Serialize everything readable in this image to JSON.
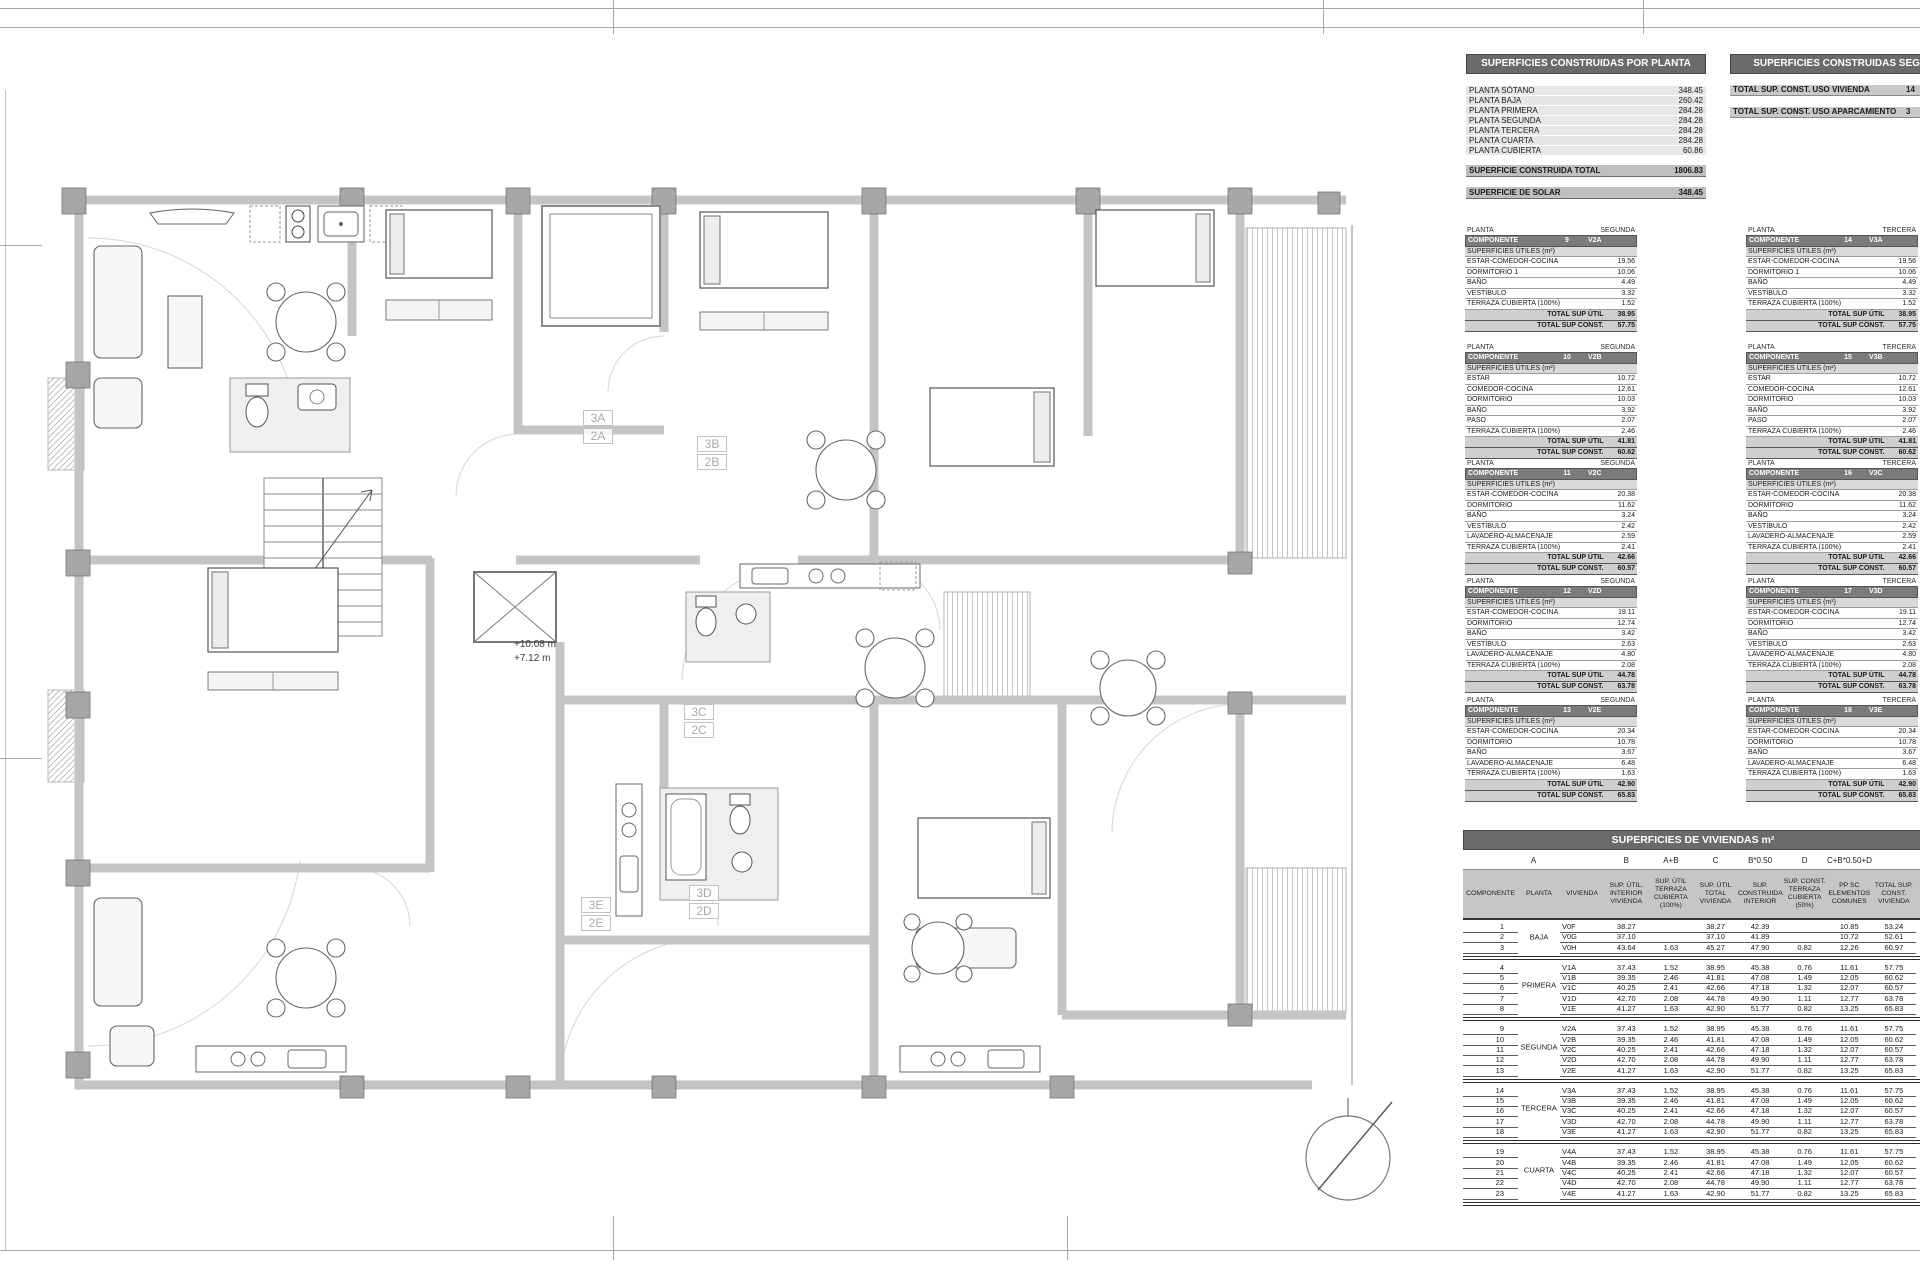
{
  "plan": {
    "elevation": {
      "line1": "+10.08 m",
      "line2": "+7.12 m"
    },
    "unit_labels": [
      {
        "line1": "3A",
        "line2": "2A",
        "style": "left:583px;top:410px"
      },
      {
        "line1": "3B",
        "line2": "2B",
        "style": "left:697px;top:436px"
      },
      {
        "line1": "3C",
        "line2": "2C",
        "style": "left:684px;top:704px"
      },
      {
        "line1": "3D",
        "line2": "2D",
        "style": "left:689px;top:885px"
      },
      {
        "line1": "3E",
        "line2": "2E",
        "style": "left:581px;top:897px"
      }
    ]
  },
  "table_por_planta": {
    "title": "SUPERFICIES CONSTRUIDAS POR PLANTA",
    "rows": [
      [
        "PLANTA SÓTANO",
        "348.45"
      ],
      [
        "PLANTA BAJA",
        "260.42"
      ],
      [
        "PLANTA PRIMERA",
        "284.28"
      ],
      [
        "PLANTA SEGUNDA",
        "284.28"
      ],
      [
        "PLANTA TERCERA",
        "284.28"
      ],
      [
        "PLANTA CUARTA",
        "284.28"
      ],
      [
        "PLANTA CUBIERTA",
        "60.86"
      ]
    ],
    "total_label": "SUPERFICIE CONSTRUIDA TOTAL",
    "total_value": "1806.83",
    "solar_label": "SUPERFICIE DE SOLAR",
    "solar_value": "348.45"
  },
  "table_segun_uso": {
    "title": "SUPERFICIES CONSTRUIDAS SEGÚN USO",
    "rows": [
      [
        "TOTAL SUP. CONST. USO VIVIENDA",
        "14"
      ],
      [
        "TOTAL SUP. CONST. USO APARCAMIENTO",
        "3"
      ]
    ]
  },
  "component_labels": {
    "planta": "PLANTA",
    "componente": "COMPONENTE",
    "section": "SUPERFICIES ÚTILES (m²)",
    "total_util": "TOTAL SUP ÚTIL",
    "total_const": "TOTAL SUP CONST."
  },
  "component_tables": [
    {
      "style": "left:1465px;top:226px",
      "planta": "SEGUNDA",
      "num": "9",
      "code": "V2A",
      "rows": [
        [
          "ESTAR-COMEDOR-COCINA",
          "19.56"
        ],
        [
          "DORMITORIO 1",
          "10.06"
        ],
        [
          "BAÑO",
          "4.49"
        ],
        [
          "VESTÍBULO",
          "3.32"
        ],
        [
          "TERRAZA CUBIERTA (100%)",
          "1.52"
        ]
      ],
      "tu": "38.95",
      "tc": "57.75"
    },
    {
      "style": "left:1465px;top:343px",
      "planta": "SEGUNDA",
      "num": "10",
      "code": "V2B",
      "rows": [
        [
          "ESTAR",
          "10.72"
        ],
        [
          "COMEDOR-COCINA",
          "12.61"
        ],
        [
          "DORMITORIO",
          "10.03"
        ],
        [
          "BAÑO",
          "3.92"
        ],
        [
          "PASO",
          "2.07"
        ],
        [
          "TERRAZA CUBIERTA (100%)",
          "2.46"
        ]
      ],
      "tu": "41.81",
      "tc": "60.62"
    },
    {
      "style": "left:1465px;top:459px",
      "planta": "SEGUNDA",
      "num": "11",
      "code": "V2C",
      "rows": [
        [
          "ESTAR-COMEDOR-COCINA",
          "20.38"
        ],
        [
          "DORMITORIO",
          "11.62"
        ],
        [
          "BAÑO",
          "3.24"
        ],
        [
          "VESTÍBULO",
          "2.42"
        ],
        [
          "LAVADERO-ALMACENAJE",
          "2.59"
        ],
        [
          "TERRAZA CUBIERTA (100%)",
          "2.41"
        ]
      ],
      "tu": "42.66",
      "tc": "60.57"
    },
    {
      "style": "left:1465px;top:577px",
      "planta": "SEGUNDA",
      "num": "12",
      "code": "V2D",
      "rows": [
        [
          "ESTAR-COMEDOR-COCINA",
          "19.11"
        ],
        [
          "DORMITORIO",
          "12.74"
        ],
        [
          "BAÑO",
          "3.42"
        ],
        [
          "VESTÍBULO",
          "2.63"
        ],
        [
          "LAVADERO-ALMACENAJE",
          "4.80"
        ],
        [
          "TERRAZA CUBIERTA (100%)",
          "2.08"
        ]
      ],
      "tu": "44.78",
      "tc": "63.78"
    },
    {
      "style": "left:1465px;top:696px",
      "planta": "SEGUNDA",
      "num": "13",
      "code": "V2E",
      "rows": [
        [
          "ESTAR-COMEDOR-COCINA",
          "20.34"
        ],
        [
          "DORMITORIO",
          "10.78"
        ],
        [
          "BAÑO",
          "3.67"
        ],
        [
          "LAVADERO-ALMACENAJE",
          "6.48"
        ],
        [
          "TERRAZA CUBIERTA (100%)",
          "1.63"
        ]
      ],
      "tu": "42.90",
      "tc": "65.83"
    },
    {
      "style": "left:1746px;top:226px",
      "planta": "TERCERA",
      "num": "14",
      "code": "V3A",
      "rows": [
        [
          "ESTAR-COMEDOR-COCINA",
          "19.56"
        ],
        [
          "DORMITORIO 1",
          "10.06"
        ],
        [
          "BAÑO",
          "4.49"
        ],
        [
          "VESTÍBULO",
          "3.32"
        ],
        [
          "TERRAZA CUBIERTA (100%)",
          "1.52"
        ]
      ],
      "tu": "38.95",
      "tc": "57.75"
    },
    {
      "style": "left:1746px;top:343px",
      "planta": "TERCERA",
      "num": "15",
      "code": "V3B",
      "rows": [
        [
          "ESTAR",
          "10.72"
        ],
        [
          "COMEDOR-COCINA",
          "12.61"
        ],
        [
          "DORMITORIO",
          "10.03"
        ],
        [
          "BAÑO",
          "3.92"
        ],
        [
          "PASO",
          "2.07"
        ],
        [
          "TERRAZA CUBIERTA (100%)",
          "2.46"
        ]
      ],
      "tu": "41.81",
      "tc": "60.62"
    },
    {
      "style": "left:1746px;top:459px",
      "planta": "TERCERA",
      "num": "16",
      "code": "V3C",
      "rows": [
        [
          "ESTAR-COMEDOR-COCINA",
          "20.38"
        ],
        [
          "DORMITORIO",
          "11.62"
        ],
        [
          "BAÑO",
          "3.24"
        ],
        [
          "VESTÍBULO",
          "2.42"
        ],
        [
          "LAVADERO-ALMACENAJE",
          "2.59"
        ],
        [
          "TERRAZA CUBIERTA (100%)",
          "2.41"
        ]
      ],
      "tu": "42.66",
      "tc": "60.57"
    },
    {
      "style": "left:1746px;top:577px",
      "planta": "TERCERA",
      "num": "17",
      "code": "V3D",
      "rows": [
        [
          "ESTAR-COMEDOR-COCINA",
          "19.11"
        ],
        [
          "DORMITORIO",
          "12.74"
        ],
        [
          "BAÑO",
          "3.42"
        ],
        [
          "VESTÍBULO",
          "2.63"
        ],
        [
          "LAVADERO-ALMACENAJE",
          "4.80"
        ],
        [
          "TERRAZA CUBIERTA (100%)",
          "2.08"
        ]
      ],
      "tu": "44.78",
      "tc": "63.78"
    },
    {
      "style": "left:1746px;top:696px",
      "planta": "TERCERA",
      "num": "18",
      "code": "V3E",
      "rows": [
        [
          "ESTAR-COMEDOR-COCINA",
          "20.34"
        ],
        [
          "DORMITORIO",
          "10.78"
        ],
        [
          "BAÑO",
          "3.67"
        ],
        [
          "LAVADERO-ALMACENAJE",
          "6.48"
        ],
        [
          "TERRAZA CUBIERTA (100%)",
          "1.63"
        ]
      ],
      "tu": "42.90",
      "tc": "65.83"
    }
  ],
  "viviendas_table": {
    "title": "SUPERFICIES DE VIVIENDAS m²",
    "formula_row": [
      "A",
      "B",
      "A+B",
      "C",
      "B*0.50",
      "D",
      "C+B*0.50+D"
    ],
    "headers": [
      "COMPONENTE",
      "PLANTA",
      "VIVIENDA",
      "SUP. ÚTIL. INTERIOR VIVIENDA",
      "SUP. ÚTIL TERRAZA CUBIERTA (100%)",
      "SUP. ÚTIL TOTAL VIVIENDA",
      "SUP. CONSTRUIDA INTERIOR",
      "SUP. CONST. TERRAZA CUBIERTA (50%)",
      "PP SC ELEMENTOS COMUNES",
      "TOTAL SUP. CONST. VIVIENDA"
    ],
    "groups": [
      {
        "planta": "BAJA",
        "rows": [
          [
            "1",
            "V0F",
            "38.27",
            "",
            "38.27",
            "42.39",
            "",
            "10.85",
            "53.24"
          ],
          [
            "2",
            "V0G",
            "37.10",
            "",
            "37.10",
            "41.89",
            "",
            "10.72",
            "52.61"
          ],
          [
            "3",
            "V0H",
            "43.64",
            "1.63",
            "45.27",
            "47.90",
            "0.82",
            "12.26",
            "60.97"
          ]
        ]
      },
      {
        "planta": "PRIMERA",
        "rows": [
          [
            "4",
            "V1A",
            "37.43",
            "1.52",
            "38.95",
            "45.38",
            "0.76",
            "11.61",
            "57.75"
          ],
          [
            "5",
            "V1B",
            "39.35",
            "2.46",
            "41.81",
            "47.08",
            "1.49",
            "12.05",
            "60.62"
          ],
          [
            "6",
            "V1C",
            "40.25",
            "2.41",
            "42.66",
            "47.18",
            "1.32",
            "12.07",
            "60.57"
          ],
          [
            "7",
            "V1D",
            "42.70",
            "2.08",
            "44.78",
            "49.90",
            "1.11",
            "12.77",
            "63.78"
          ],
          [
            "8",
            "V1E",
            "41.27",
            "1.63",
            "42.90",
            "51.77",
            "0.82",
            "13.25",
            "65.83"
          ]
        ]
      },
      {
        "planta": "SEGUNDA",
        "rows": [
          [
            "9",
            "V2A",
            "37.43",
            "1.52",
            "38.95",
            "45.38",
            "0.76",
            "11.61",
            "57.75"
          ],
          [
            "10",
            "V2B",
            "39.35",
            "2.46",
            "41.81",
            "47.08",
            "1.49",
            "12.05",
            "60.62"
          ],
          [
            "11",
            "V2C",
            "40.25",
            "2.41",
            "42.66",
            "47.18",
            "1.32",
            "12.07",
            "60.57"
          ],
          [
            "12",
            "V2D",
            "42.70",
            "2.08",
            "44.78",
            "49.90",
            "1.11",
            "12.77",
            "63.78"
          ],
          [
            "13",
            "V2E",
            "41.27",
            "1.63",
            "42.90",
            "51.77",
            "0.82",
            "13.25",
            "65.83"
          ]
        ]
      },
      {
        "planta": "TERCERA",
        "rows": [
          [
            "14",
            "V3A",
            "37.43",
            "1.52",
            "38.95",
            "45.38",
            "0.76",
            "11.61",
            "57.75"
          ],
          [
            "15",
            "V3B",
            "39.35",
            "2.46",
            "41.81",
            "47.08",
            "1.49",
            "12.05",
            "60.62"
          ],
          [
            "16",
            "V3C",
            "40.25",
            "2.41",
            "42.66",
            "47.18",
            "1.32",
            "12.07",
            "60.57"
          ],
          [
            "17",
            "V3D",
            "42.70",
            "2.08",
            "44.78",
            "49.90",
            "1.11",
            "12.77",
            "63.78"
          ],
          [
            "18",
            "V3E",
            "41.27",
            "1.63",
            "42.90",
            "51.77",
            "0.82",
            "13.25",
            "65.83"
          ]
        ]
      },
      {
        "planta": "CUARTA",
        "rows": [
          [
            "19",
            "V4A",
            "37.43",
            "1.52",
            "38.95",
            "45.38",
            "0.76",
            "11.61",
            "57.75"
          ],
          [
            "20",
            "V4B",
            "39.35",
            "2.46",
            "41.81",
            "47.08",
            "1.49",
            "12.05",
            "60.62"
          ],
          [
            "21",
            "V4C",
            "40.25",
            "2.41",
            "42.66",
            "47.18",
            "1.32",
            "12.07",
            "60.57"
          ],
          [
            "22",
            "V4D",
            "42.70",
            "2.08",
            "44.78",
            "49.90",
            "1.11",
            "12.77",
            "63.78"
          ],
          [
            "23",
            "V4E",
            "41.27",
            "1.63",
            "42.90",
            "51.77",
            "0.82",
            "13.25",
            "65.83"
          ]
        ]
      }
    ]
  }
}
